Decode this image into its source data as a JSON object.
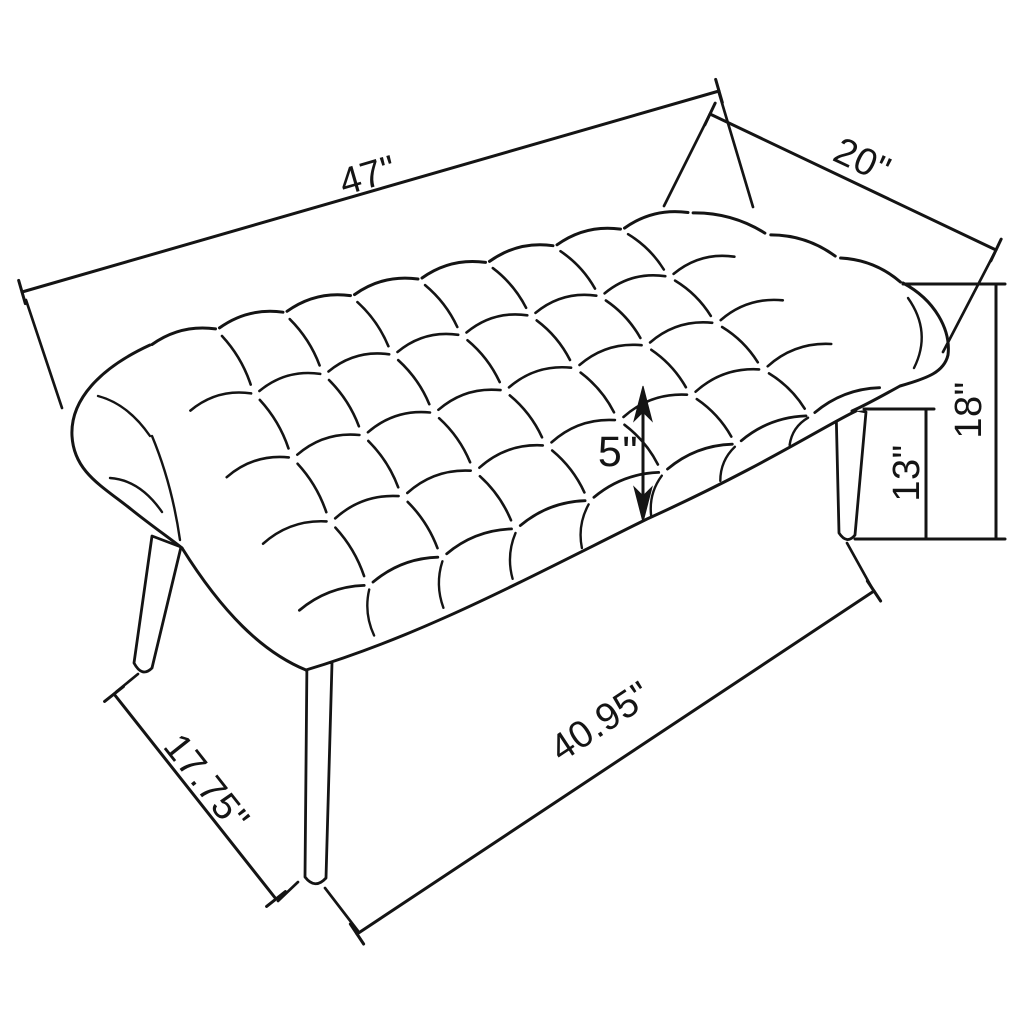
{
  "diagram": {
    "subject": "tufted-bench-dimension-diagram",
    "view": "three-quarter perspective line drawing",
    "background_color": "#ffffff",
    "line_color": "#141414",
    "unit": "inches",
    "dimensions": {
      "overall_length": "47\"",
      "overall_depth": "20\"",
      "overall_height": "18\"",
      "leg_height": "13\"",
      "cushion_thickness": "5\"",
      "base_length": "40.95\"",
      "base_depth": "17.75\""
    }
  }
}
